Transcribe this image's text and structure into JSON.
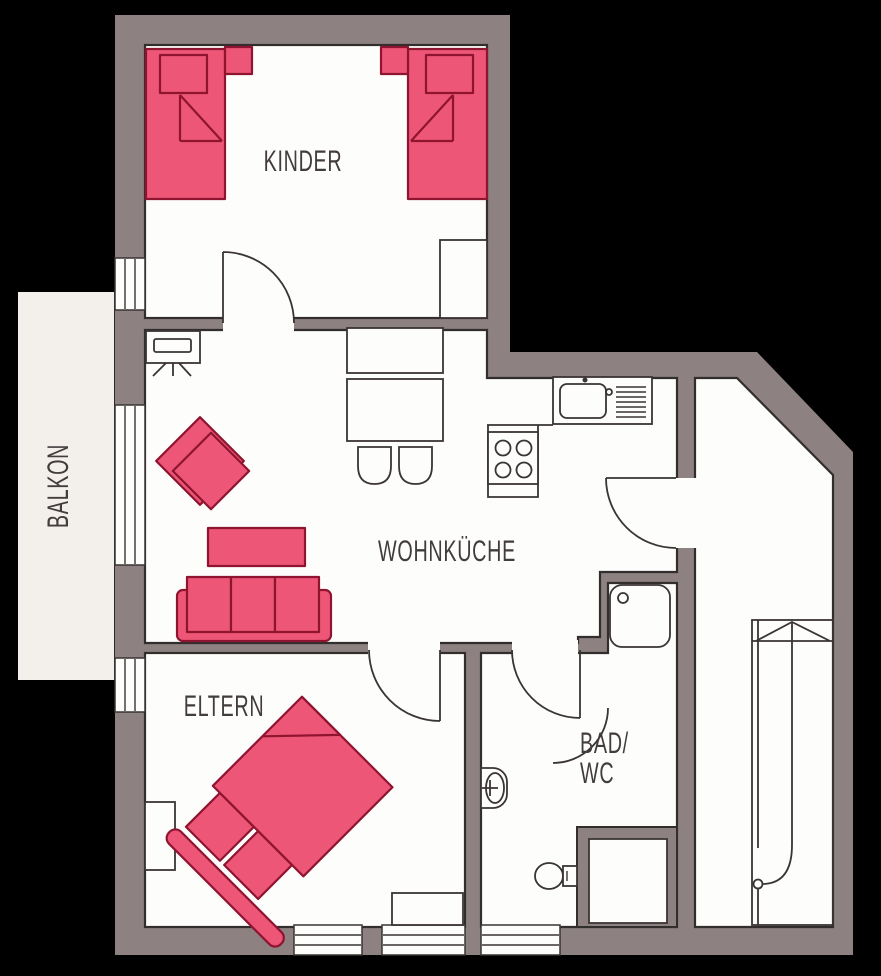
{
  "type": "apartment-floor-plan",
  "rooms": {
    "kinder": "KINDER",
    "wohnkueche": "WOHNKÜCHE",
    "eltern": "ELTERN",
    "bad_line1": "BAD/",
    "bad_line2": "WC",
    "balkon": "BALKON"
  },
  "colors": {
    "background": "#000000",
    "wall": "#8d8181",
    "floor": "#fdfdfc",
    "balcony": "#f3f0ec",
    "furniture_fill": "#ee5677",
    "furniture_outline": "#8e1430",
    "line": "#3a3434",
    "room_outline": "#332e2e",
    "label_text": "#423c3c"
  }
}
